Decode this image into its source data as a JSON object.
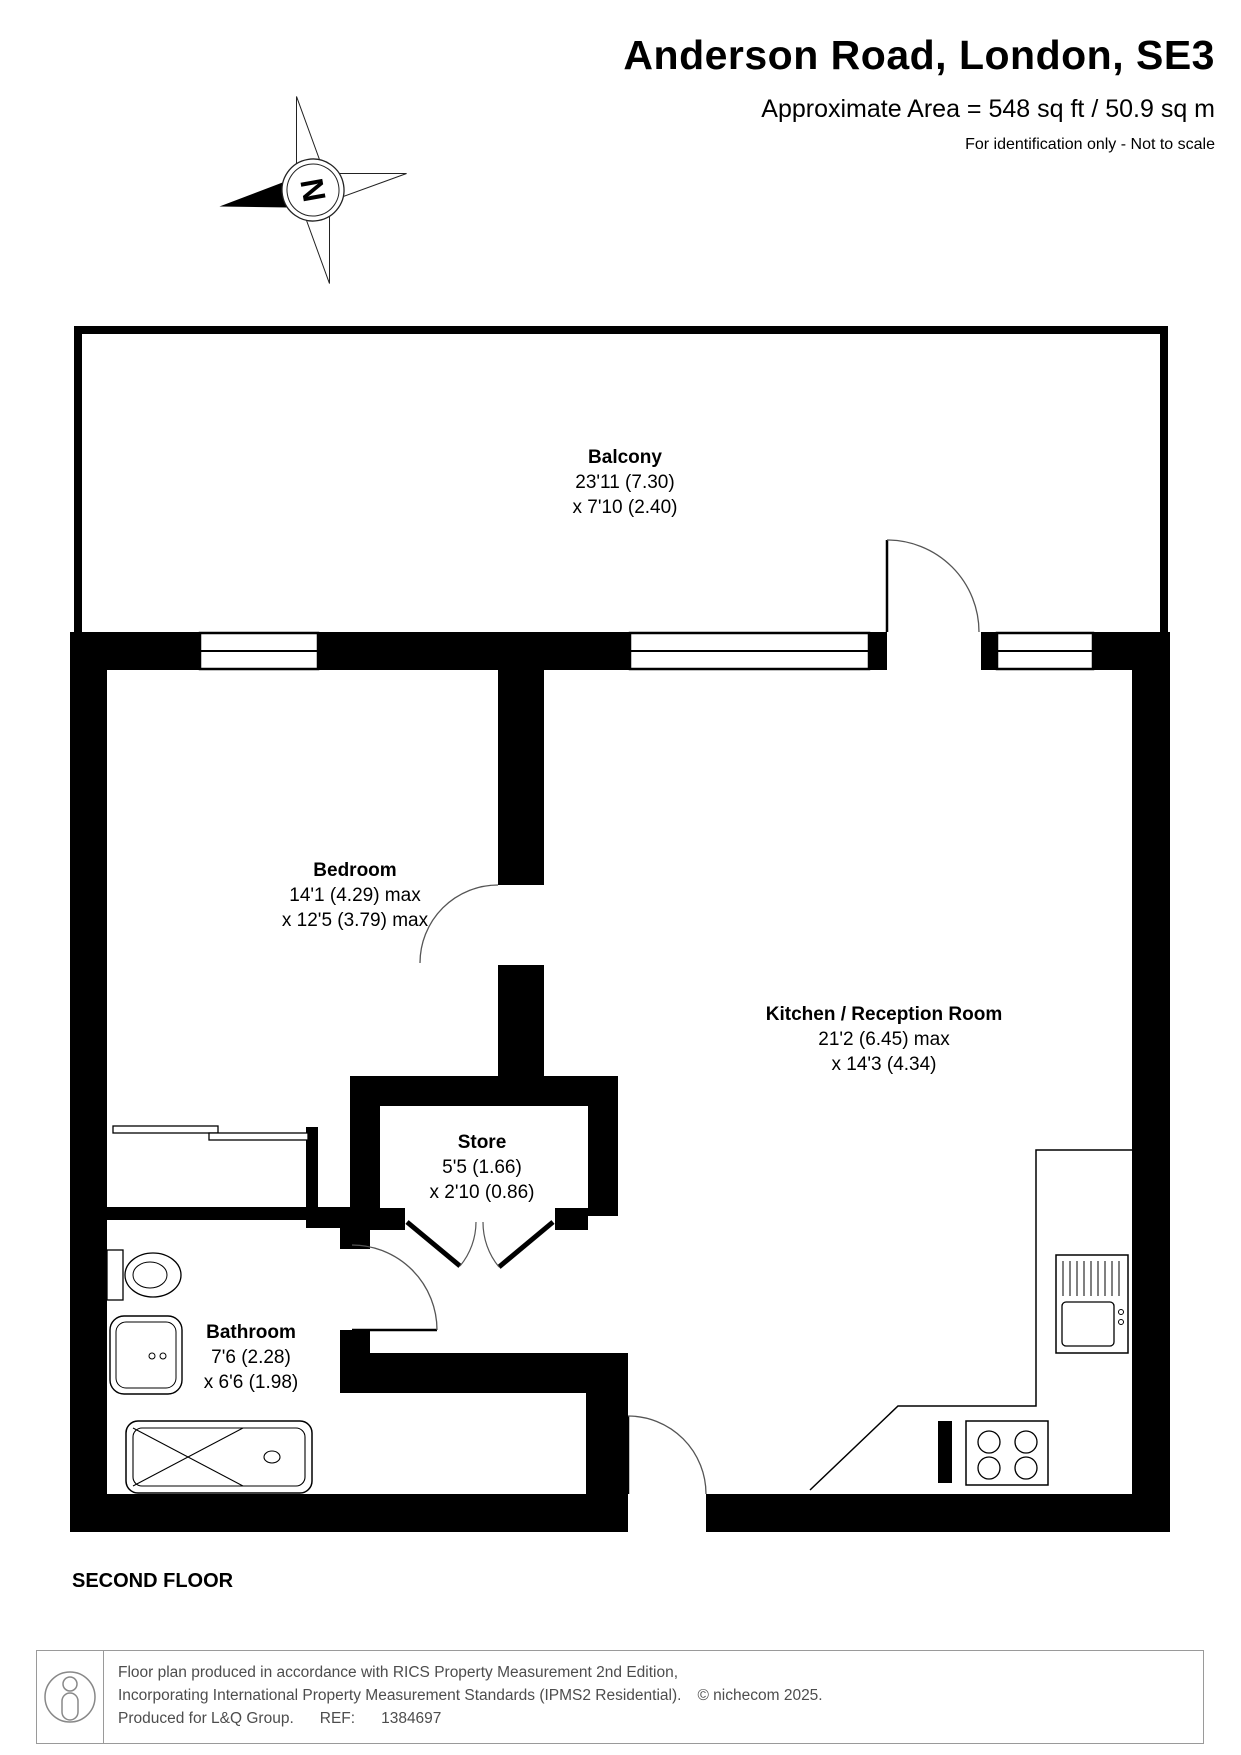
{
  "header": {
    "title": "Anderson Road, London, SE3",
    "area": "Approximate Area = 548 sq ft / 50.9 sq m",
    "note": "For identification only - Not to scale"
  },
  "compass": {
    "label": "N"
  },
  "rooms": [
    {
      "id": "balcony",
      "name": "Balcony",
      "dim1": "23'11 (7.30)",
      "dim2": "x 7'10 (2.40)"
    },
    {
      "id": "bedroom",
      "name": "Bedroom",
      "dim1": "14'1 (4.29) max",
      "dim2": "x 12'5 (3.79) max"
    },
    {
      "id": "kitchen",
      "name": "Kitchen / Reception Room",
      "dim1": "21'2 (6.45) max",
      "dim2": "x 14'3 (4.34)"
    },
    {
      "id": "store",
      "name": "Store",
      "dim1": "5'5 (1.66)",
      "dim2": "x 2'10 (0.86)"
    },
    {
      "id": "bathroom",
      "name": "Bathroom",
      "dim1": "7'6 (2.28)",
      "dim2": "x 6'6 (1.98)"
    }
  ],
  "floor_label": "SECOND FLOOR",
  "footer": {
    "line1": "Floor plan produced in accordance with RICS Property Measurement 2nd Edition,",
    "line2": "Incorporating International Property Measurement Standards (IPMS2 Residential).",
    "copyright": "© nichecom 2025.",
    "line3_produced": "Produced for L&Q Group.",
    "line3_ref_label": "REF:",
    "line3_ref": "1384697"
  },
  "colors": {
    "wall": "#000000",
    "footer_text": "#4d4d4d",
    "arc": "#555555"
  }
}
